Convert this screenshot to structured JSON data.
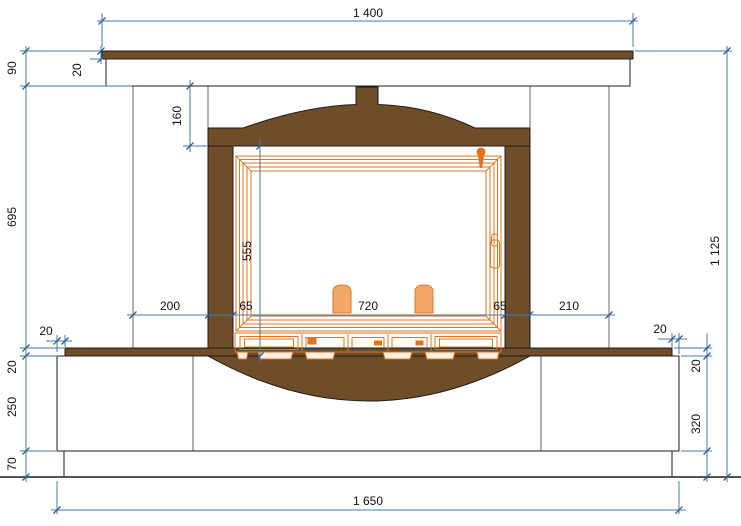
{
  "dimensions": {
    "mantel_width": "1 400",
    "mantel_height": "90",
    "mantel_top_thickness": "20",
    "flue_band_height": "160",
    "body_height": "695",
    "door_height": "555",
    "left_column_width": "200",
    "left_jamb_width": "65",
    "opening_width": "720",
    "right_jamb_width": "65",
    "right_column_width": "210",
    "hearth_inset_left": "20",
    "hearth_thickness_left": "20",
    "plinth_height": "250",
    "base_band_height": "70",
    "hearth_inset_right": "20",
    "hearth_thickness_right": "20",
    "base_total_height_right": "320",
    "overall_height": "1 125",
    "overall_base_width": "1 650"
  },
  "colors": {
    "wood": "#6f4d29",
    "insert": "#e0741e",
    "insert_light": "#f4a96c",
    "dim_line": "#4579ad",
    "ink": "#111111",
    "outline": "#1c1c1c"
  }
}
